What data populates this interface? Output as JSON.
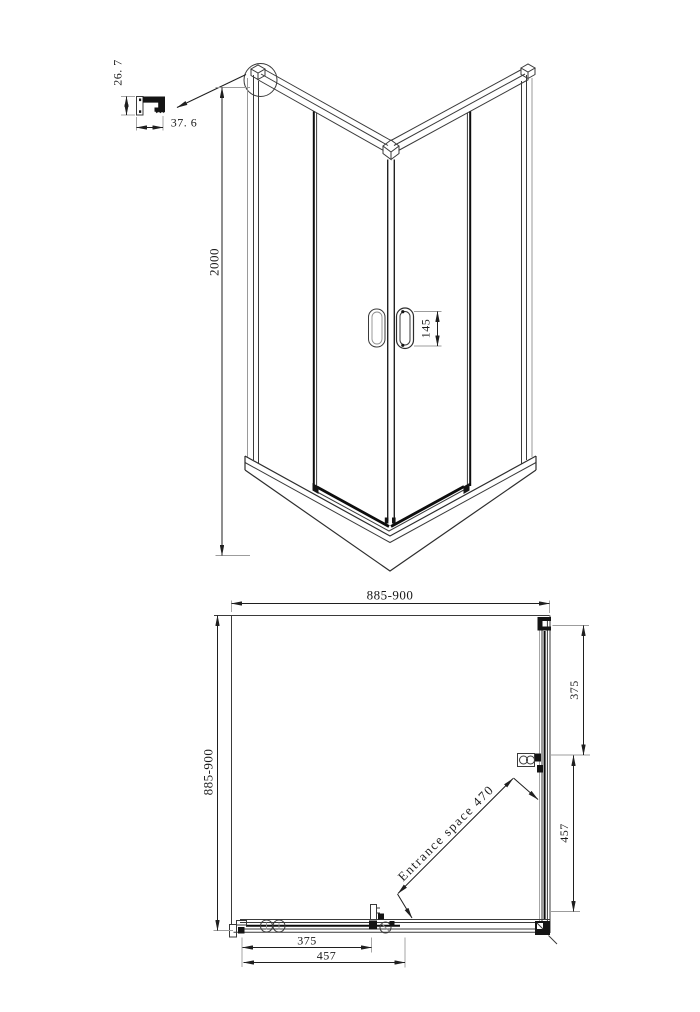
{
  "colors": {
    "background": "#ffffff",
    "ink": "#1a1a1a"
  },
  "profile_detail": {
    "height": "26. 7",
    "width": "37. 6"
  },
  "iso_view": {
    "height": "2000",
    "handle_height": "145"
  },
  "plan_view": {
    "width": "885-900",
    "depth": "885-900",
    "side_fixed_panel": "375",
    "side_door": "457",
    "front_fixed_panel": "375",
    "front_door": "457",
    "entrance": "Entrance space 470"
  }
}
